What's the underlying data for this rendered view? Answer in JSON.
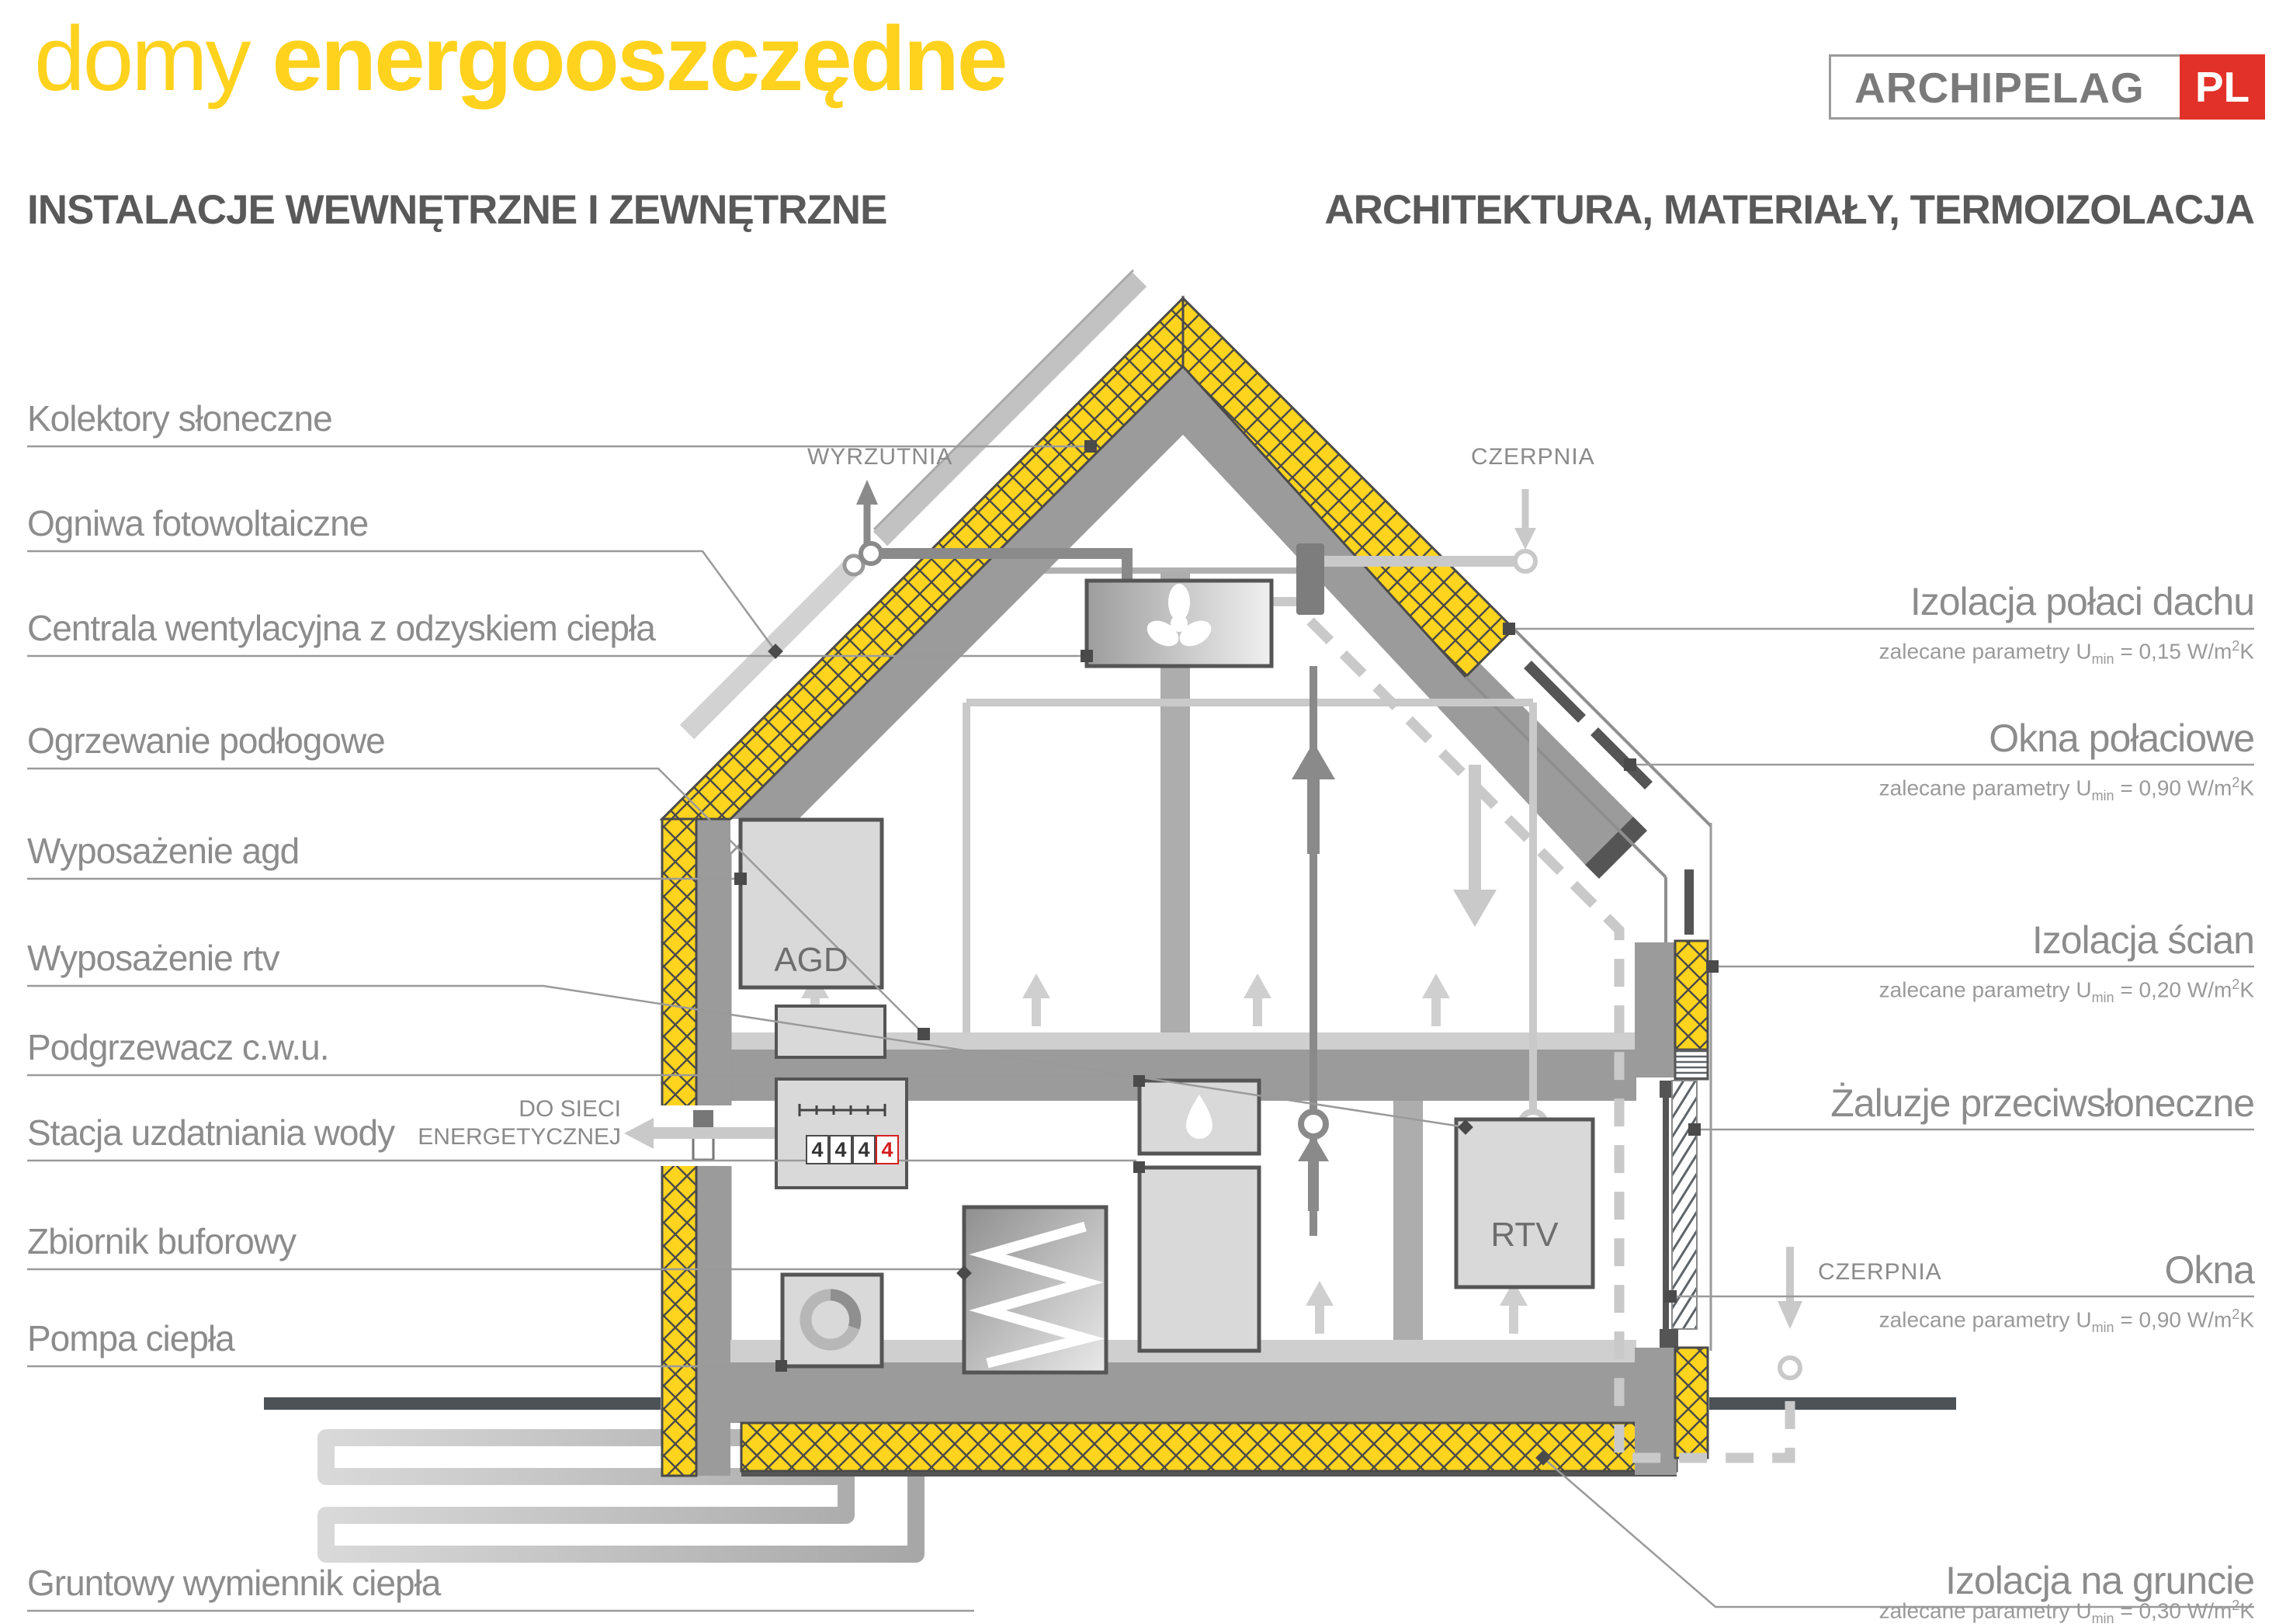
{
  "title": {
    "light": "domy",
    "bold": "energooszczędne"
  },
  "logo": {
    "name": "ARCHIPELAG",
    "tld": "PL"
  },
  "headers": {
    "left": "INSTALACJE WEWNĘTRZNE I ZEWNĘTRZNE",
    "right": "ARCHITEKTURA, MATERIAŁY, TERMOIZOLACJA"
  },
  "left_labels": [
    {
      "label": "Kolektory słoneczne"
    },
    {
      "label": "Ogniwa fotowoltaiczne"
    },
    {
      "label": "Centrala wentylacyjna z odzyskiem ciepła"
    },
    {
      "label": "Ogrzewanie podłogowe"
    },
    {
      "label": "Wyposażenie agd"
    },
    {
      "label": "Wyposażenie rtv"
    },
    {
      "label": "Podgrzewacz c.w.u."
    },
    {
      "label": "Stacja uzdatniania wody"
    },
    {
      "label": "Zbiornik buforowy"
    },
    {
      "label": "Pompa ciepła"
    },
    {
      "label": "Gruntowy wymiennik ciepła"
    }
  ],
  "right_labels": [
    {
      "title": "Izolacja połaci dachu",
      "param": {
        "pre": "zalecane parametry U",
        "sub": "min",
        "mid": " = 0,15 W/m",
        "sup": "2",
        "post": "K"
      }
    },
    {
      "title": "Okna połaciowe",
      "param": {
        "pre": "zalecane parametry U",
        "sub": "min",
        "mid": " = 0,90 W/m",
        "sup": "2",
        "post": "K"
      }
    },
    {
      "title": "Izolacja ścian",
      "param": {
        "pre": "zalecane parametry U",
        "sub": "min",
        "mid": " = 0,20 W/m",
        "sup": "2",
        "post": "K"
      }
    },
    {
      "title": "Żaluzje przeciwsłoneczne",
      "param": null
    },
    {
      "title": "Okna",
      "param": {
        "pre": "zalecane parametry U",
        "sub": "min",
        "mid": " = 0,90 W/m",
        "sup": "2",
        "post": "K"
      }
    },
    {
      "title": "Izolacja na gruncie",
      "param": {
        "pre": "zalecane parametry U",
        "sub": "min",
        "mid": " = 0,30 W/m",
        "sup": "2",
        "post": "K"
      }
    }
  ],
  "house": {
    "wyrzutnia": "WYRZUTNIA",
    "czerpnia_top": "CZERPNIA",
    "czerpnia_side": "CZERPNIA",
    "grid_line1": "DO SIECI",
    "grid_line2": "ENERGETYCZNEJ",
    "agd": "AGD",
    "rtv": "RTV",
    "meter_digits": [
      "4",
      "4",
      "4",
      "4"
    ]
  },
  "colors": {
    "accent_yellow": "#FFD21E",
    "insulation_yellow": "#FFD41F",
    "structure_gray": "#9B9B9B",
    "label_gray": "#8C8C8C",
    "logo_red": "#E23128",
    "meter_alert_red": "#D42020"
  }
}
